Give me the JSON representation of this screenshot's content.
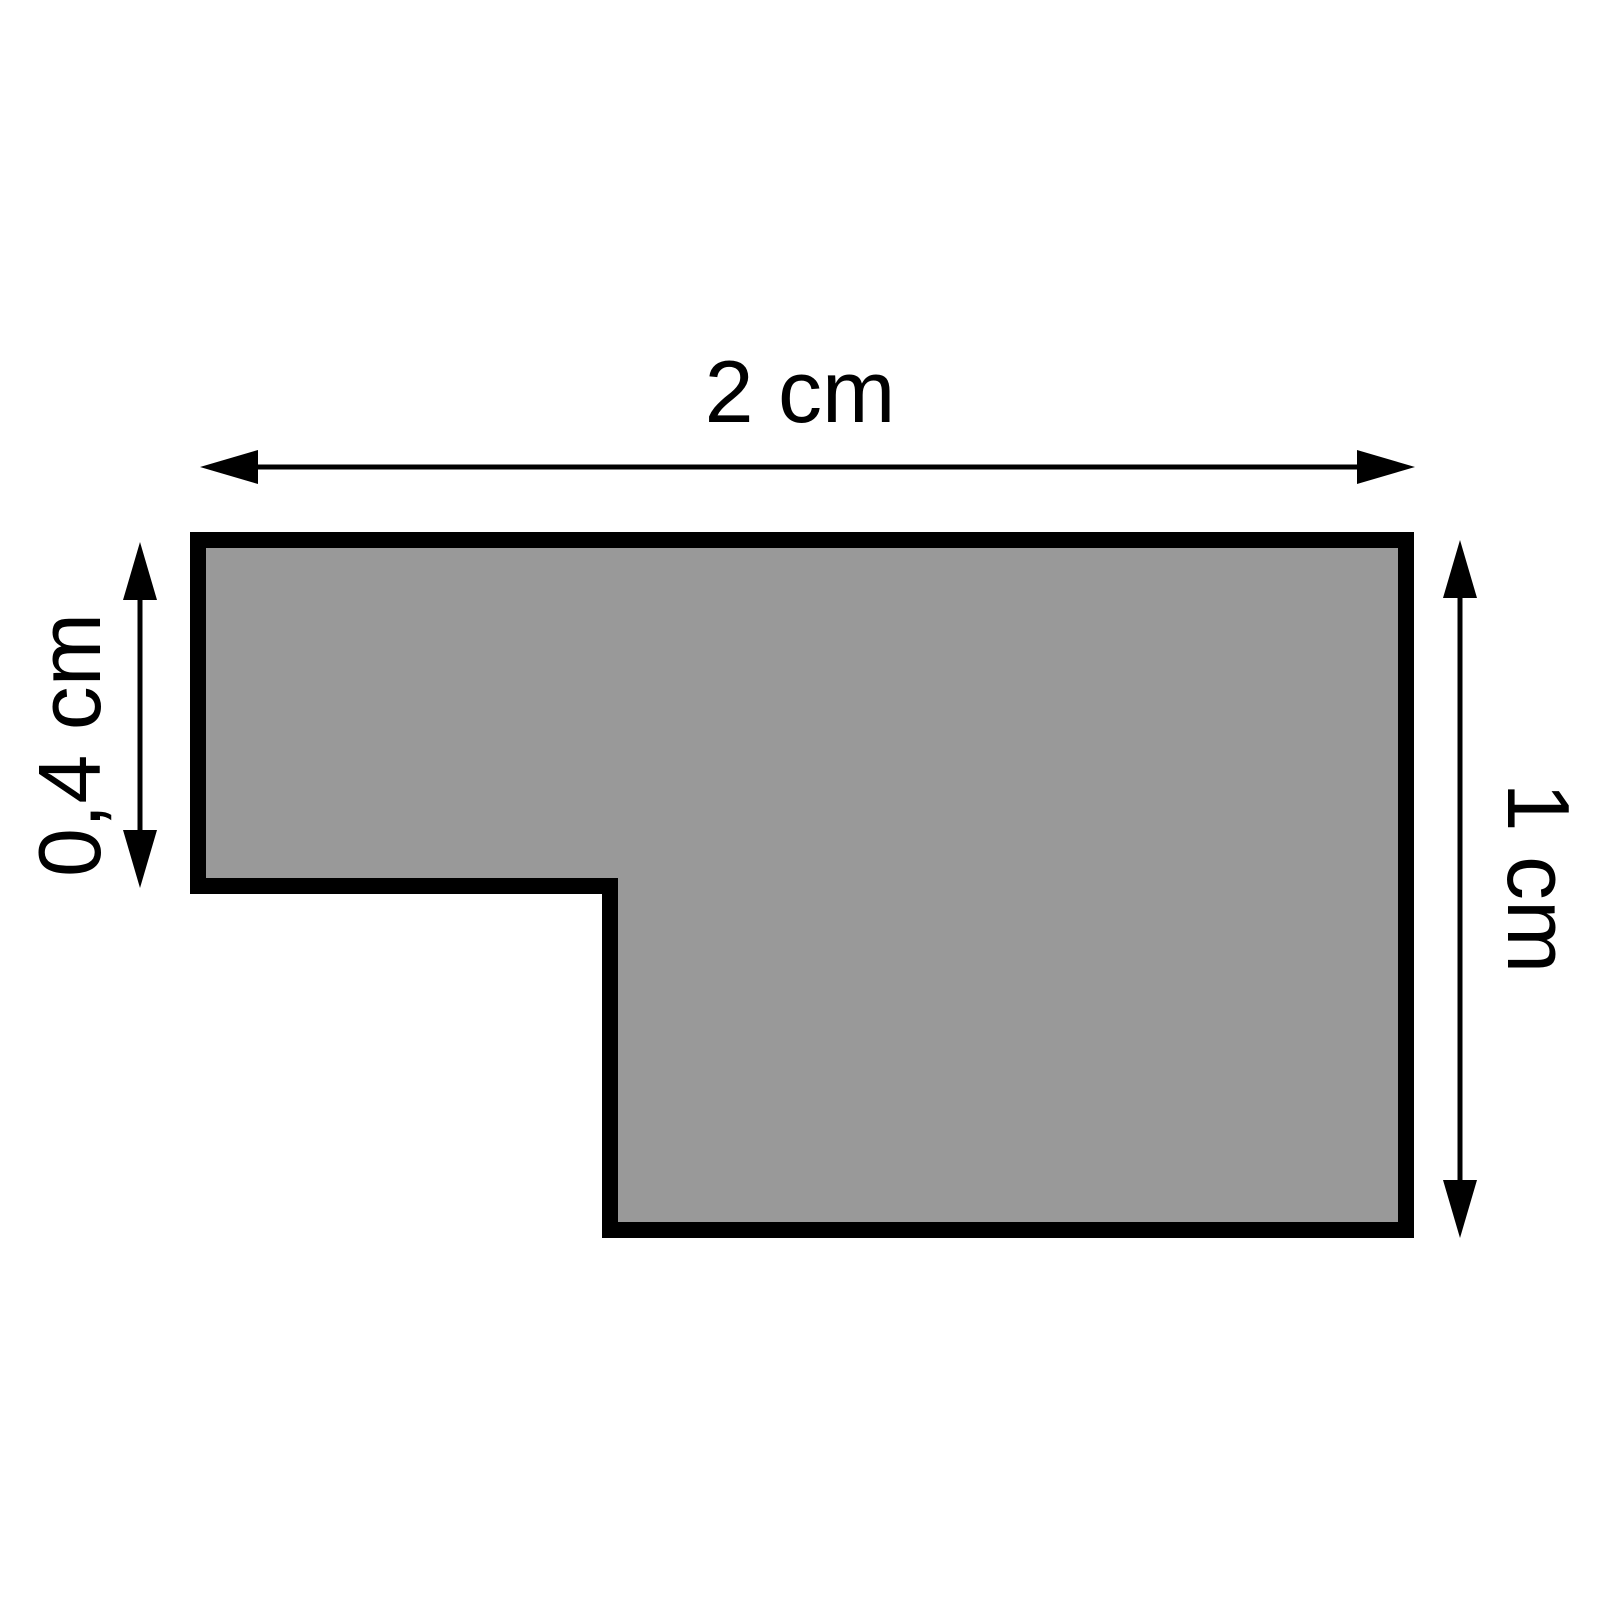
{
  "diagram": {
    "shape": {
      "type": "l-shaped-polygon",
      "fill_color": "#999999",
      "outline_color": "#000000"
    },
    "dimensions": {
      "width_label": "2 cm",
      "left_height_label": "0,4 cm",
      "right_height_label": "1 cm"
    },
    "background_color": "#ffffff"
  }
}
